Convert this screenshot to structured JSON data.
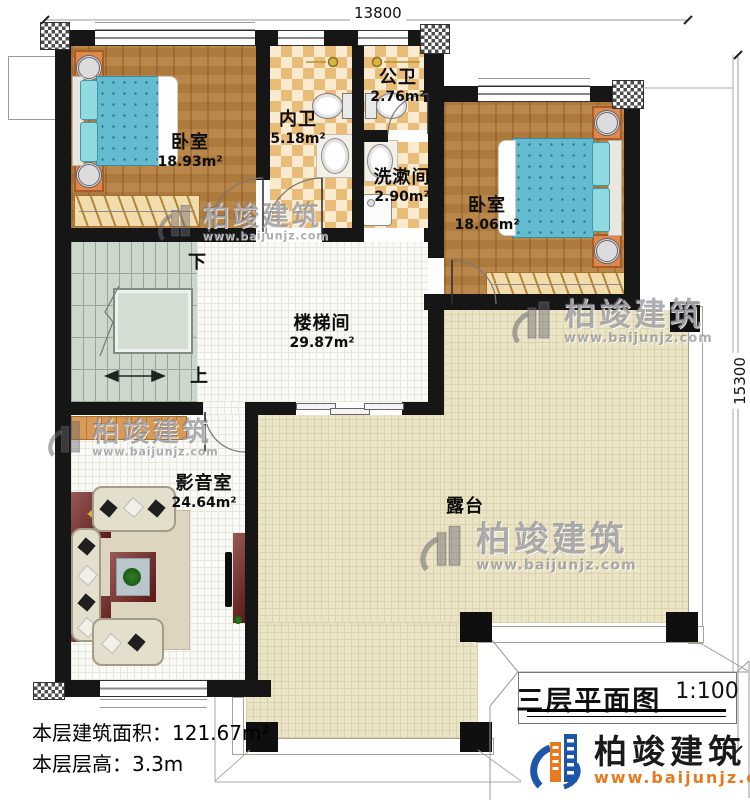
{
  "dimensions": {
    "top": "13800",
    "right": "15300"
  },
  "rooms": [
    {
      "name": "卧室",
      "area": "18.93m²"
    },
    {
      "name": "内卫",
      "area": "5.18m²"
    },
    {
      "name": "公卫",
      "area": "2.76m²"
    },
    {
      "name": "洗漱间",
      "area": "2.90m²"
    },
    {
      "name": "卧室",
      "area": "18.06m²"
    },
    {
      "name": "楼梯间",
      "area": "29.87m²"
    },
    {
      "name": "影音室",
      "area": "24.64m²"
    },
    {
      "name": "露台",
      "area": ""
    }
  ],
  "stairs": {
    "down": "下",
    "up": "上"
  },
  "info": {
    "line1_label": "本层建筑面积：",
    "line1_value": "121.67m²",
    "line2_label": "本层层高：",
    "line2_value": "3.3m"
  },
  "title_block": {
    "title": "三层平面图",
    "scale": "1:100",
    "brand": "柏竣建筑",
    "website": "www.baijunjz.com"
  },
  "watermark": {
    "brand": "柏竣建筑",
    "website": "www.baijunjz.com"
  },
  "colors": {
    "wall": "#161616",
    "wood_floor": "#b5803f",
    "bath_checker": "#e9bd77",
    "stair": "#ccd8cb",
    "terrace": "#ece4c6",
    "brand_blue": "#1d56a8",
    "brand_orange": "#e87a1e"
  }
}
